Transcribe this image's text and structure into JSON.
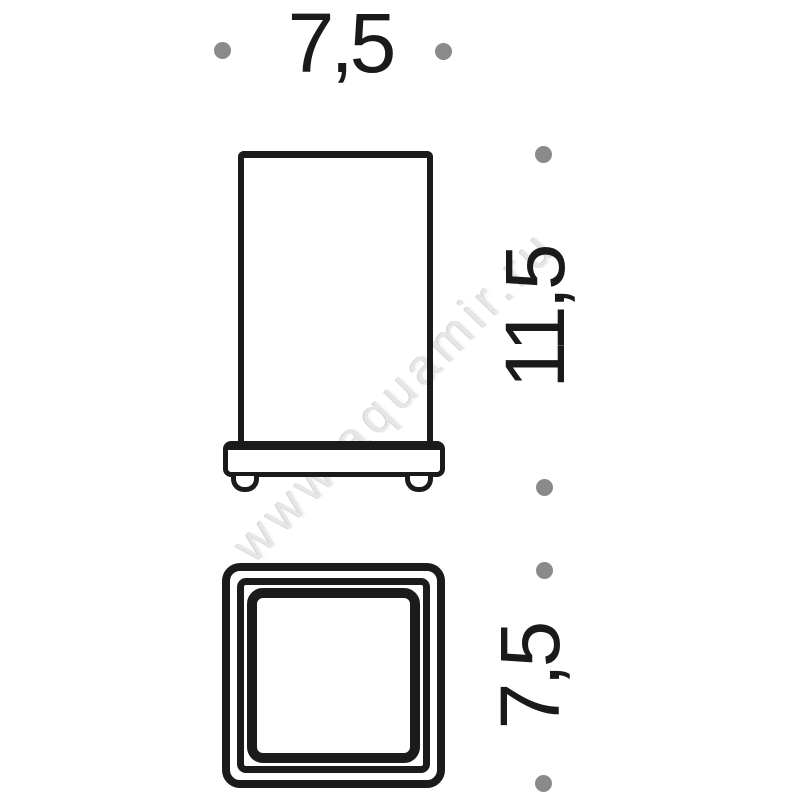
{
  "watermark": {
    "text": "www.aquamir.ru",
    "color": "#e6e6e6"
  },
  "drawing": {
    "type": "technical-dimension-drawing",
    "line_color": "#1b1b1b",
    "dot_color": "#8a8a8a",
    "background": "#ffffff",
    "dims": {
      "top_width": "7,5",
      "side_height": "11,5",
      "bottom_depth": "7,5"
    }
  }
}
